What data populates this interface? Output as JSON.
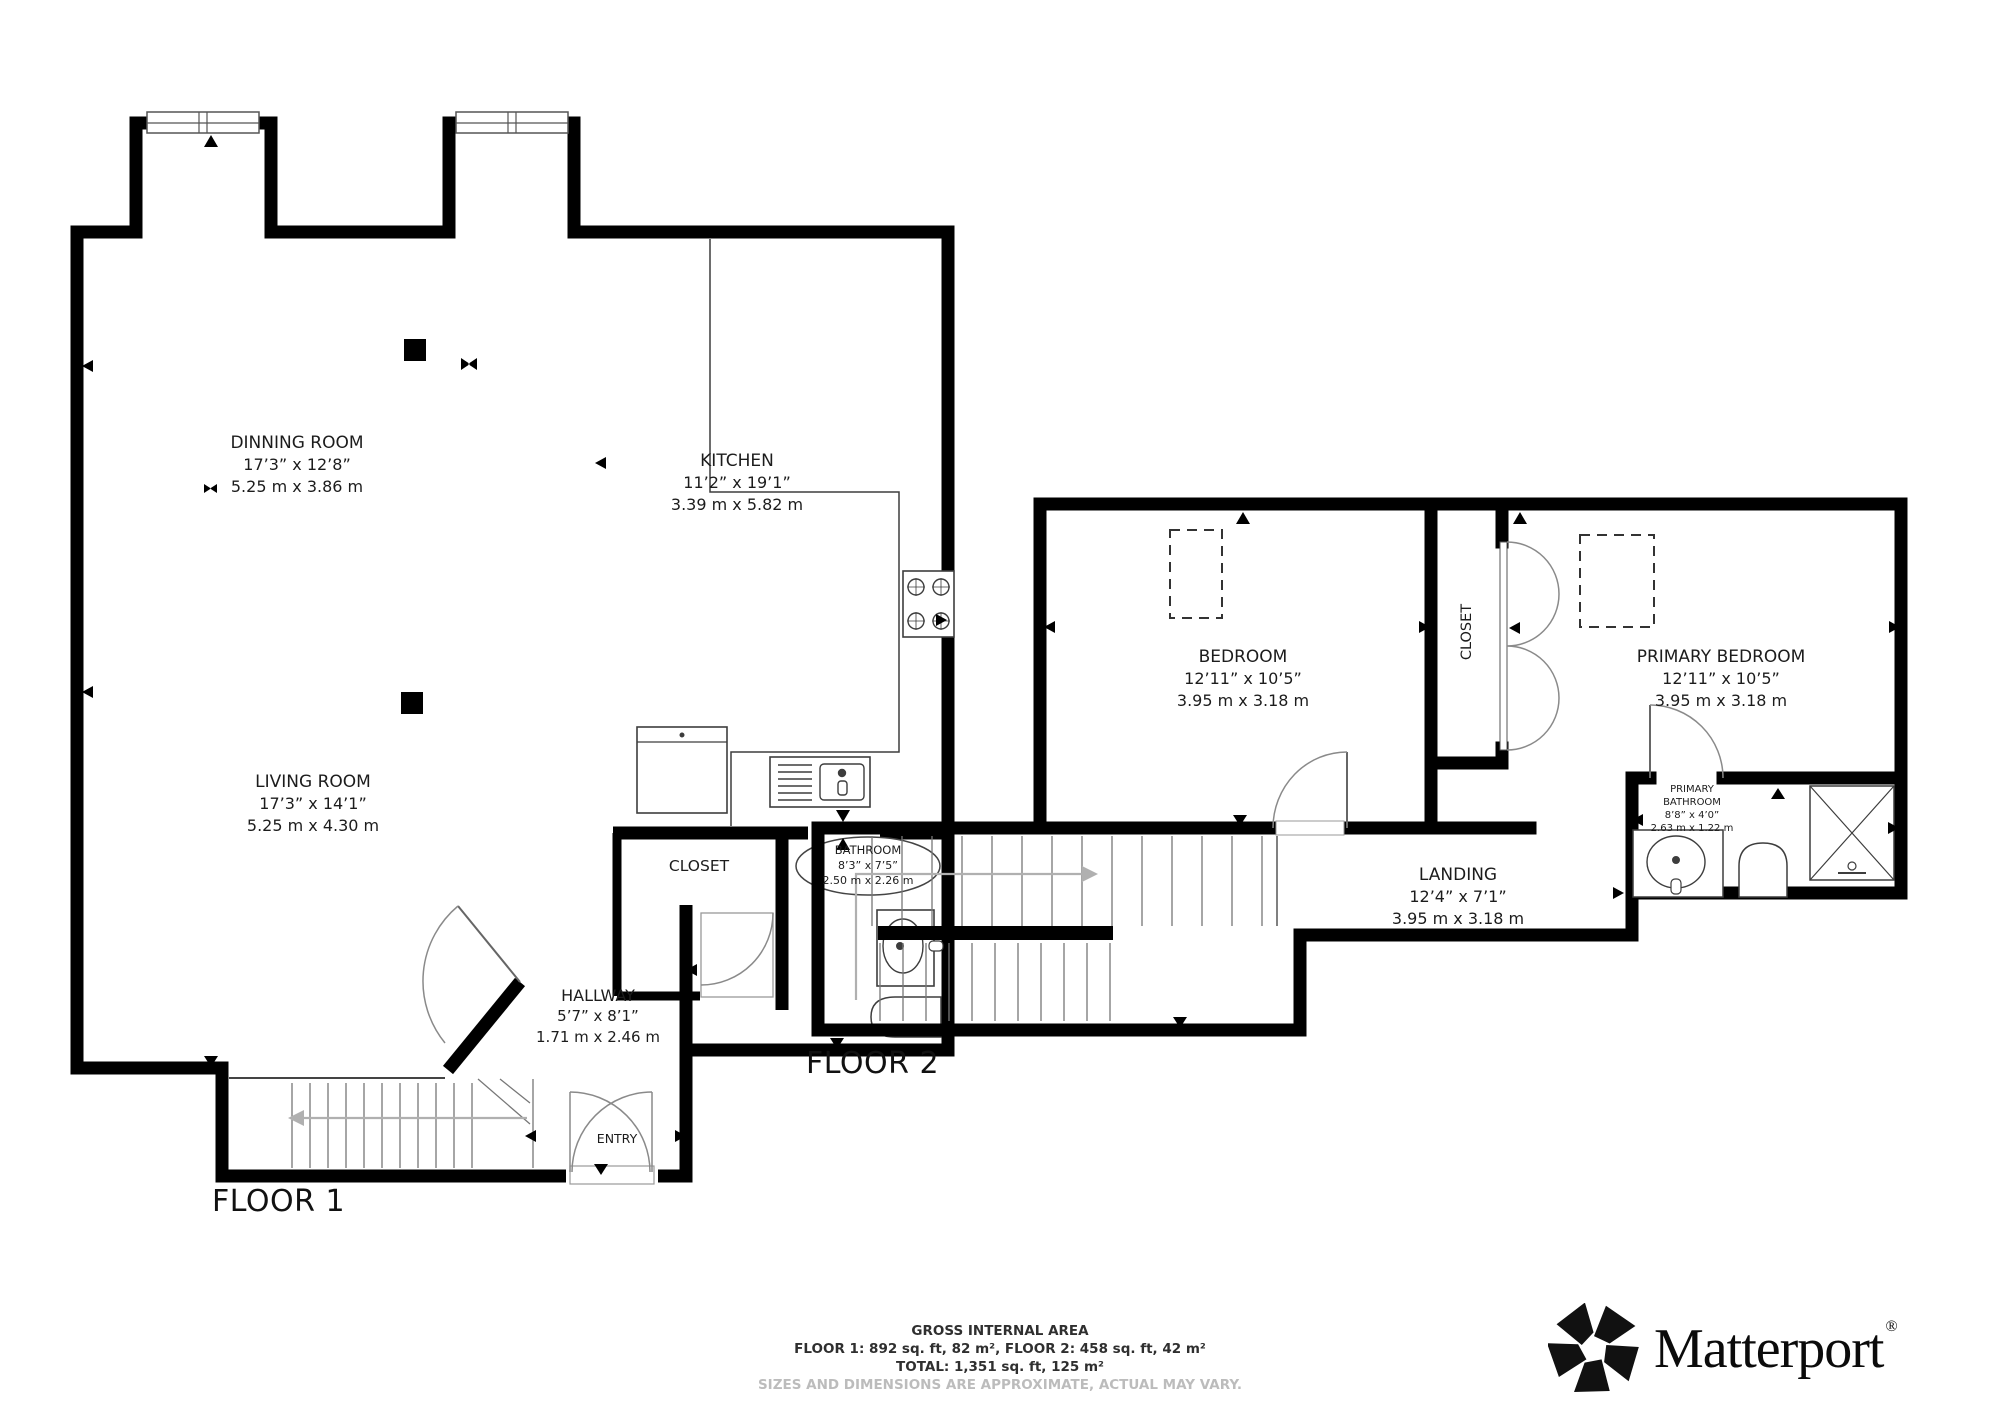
{
  "floor1": {
    "label": "FLOOR 1",
    "rooms": {
      "dinning": {
        "name": "DINNING ROOM",
        "imperial": "17’3” x 12’8”",
        "metric": "5.25 m x 3.86 m"
      },
      "kitchen": {
        "name": "KITCHEN",
        "imperial": "11’2” x 19’1”",
        "metric": "3.39 m x 5.82 m"
      },
      "living": {
        "name": "LIVING ROOM",
        "imperial": "17’3” x 14’1”",
        "metric": "5.25 m x 4.30 m"
      },
      "closet": {
        "name": "CLOSET"
      },
      "bathroom": {
        "name": "BATHROOM",
        "imperial": "8’3” x 7’5”",
        "metric": "2.50 m x 2.26 m"
      },
      "hallway": {
        "name": "HALLWAY",
        "imperial": "5’7” x 8’1”",
        "metric": "1.71 m x 2.46 m"
      },
      "entry": {
        "name": "ENTRY"
      }
    }
  },
  "floor2": {
    "label": "FLOOR 2",
    "rooms": {
      "bedroom": {
        "name": "BEDROOM",
        "imperial": "12’11” x 10’5”",
        "metric": "3.95 m x 3.18 m"
      },
      "closet": {
        "name": "CLOSET"
      },
      "primary_bedroom": {
        "name": "PRIMARY BEDROOM",
        "imperial": "12’11” x 10’5”",
        "metric": "3.95 m x 3.18 m"
      },
      "primary_bathroom": {
        "name_line1": "PRIMARY",
        "name_line2": "BATHROOM",
        "imperial": "8’8” x 4’0”",
        "metric": "2.63 m x 1.22 m"
      },
      "landing": {
        "name": "LANDING",
        "imperial": "12’4” x 7’1”",
        "metric": "3.95 m x 3.18 m"
      }
    }
  },
  "footer": {
    "title": "GROSS INTERNAL AREA",
    "floors": "FLOOR 1: 892 sq. ft, 82 m², FLOOR 2: 458 sq. ft, 42 m²",
    "total": "TOTAL: 1,351 sq. ft, 125 m²",
    "disclaimer": "SIZES AND DIMENSIONS ARE APPROXIMATE, ACTUAL MAY VARY."
  },
  "brand": {
    "name": "Matterport",
    "registered": "®"
  },
  "colors": {
    "wall": "#000000",
    "label": "#1c1c1c",
    "muted": "#bcbcbc",
    "fixture": "#3d3d3d",
    "arrow": "#b0b0b0"
  }
}
